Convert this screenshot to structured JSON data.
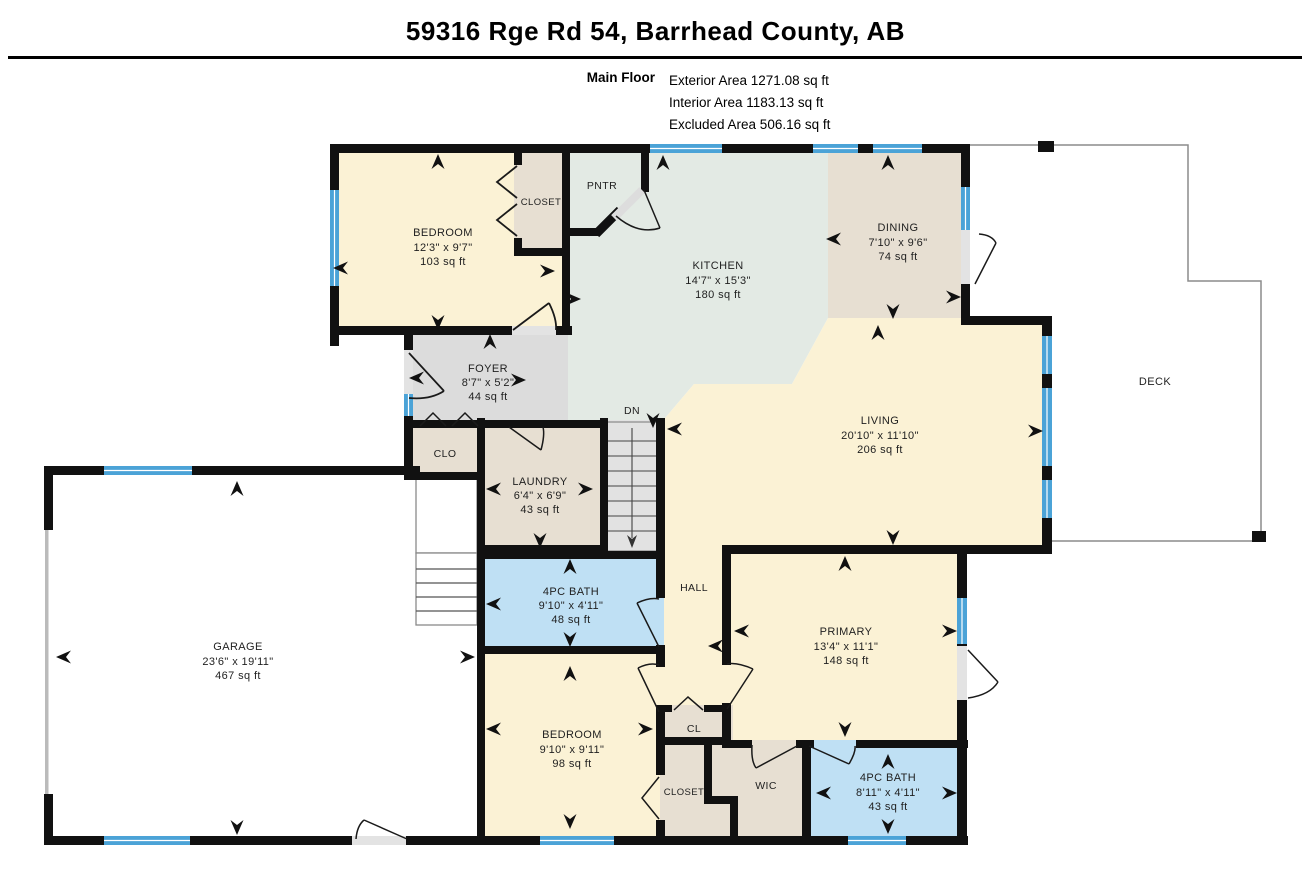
{
  "header": {
    "title": "59316 Rge Rd 54, Barrhead County, AB",
    "floor_label": "Main Floor",
    "stats": [
      "Exterior Area 1271.08 sq ft",
      "Interior Area 1183.13 sq ft",
      "Excluded Area 506.16 sq ft"
    ]
  },
  "rooms": {
    "bedroom_tl": {
      "name": "BEDROOM",
      "dims": "12'3\" x 9'7\"",
      "area": "103 sq ft"
    },
    "closet_tl": {
      "name": "CLOSET"
    },
    "pantry": {
      "name": "PNTR"
    },
    "kitchen": {
      "name": "KITCHEN",
      "dims": "14'7\" x 15'3\"",
      "area": "180 sq ft"
    },
    "dining": {
      "name": "DINING",
      "dims": "7'10\" x 9'6\"",
      "area": "74 sq ft"
    },
    "foyer": {
      "name": "FOYER",
      "dims": "8'7\" x 5'2\"",
      "area": "44 sq ft"
    },
    "living": {
      "name": "LIVING",
      "dims": "20'10\" x 11'10\"",
      "area": "206 sq ft"
    },
    "deck": {
      "name": "DECK"
    },
    "clo": {
      "name": "CLO"
    },
    "laundry": {
      "name": "LAUNDRY",
      "dims": "6'4\" x 6'9\"",
      "area": "43 sq ft"
    },
    "stairs": {
      "name": "DN"
    },
    "garage": {
      "name": "GARAGE",
      "dims": "23'6\" x 19'11\"",
      "area": "467 sq ft"
    },
    "bath_main": {
      "name": "4PC BATH",
      "dims": "9'10\" x 4'11\"",
      "area": "48 sq ft"
    },
    "hall": {
      "name": "HALL"
    },
    "primary": {
      "name": "PRIMARY",
      "dims": "13'4\" x 11'1\"",
      "area": "148 sq ft"
    },
    "bedroom_b": {
      "name": "BEDROOM",
      "dims": "9'10\" x 9'11\"",
      "area": "98 sq ft"
    },
    "cl": {
      "name": "CL"
    },
    "closet_b": {
      "name": "CLOSET"
    },
    "wic": {
      "name": "WIC"
    },
    "bath_ensuite": {
      "name": "4PC BATH",
      "dims": "8'11\" x 4'11\"",
      "area": "43 sq ft"
    }
  },
  "colors": {
    "room_cream": "#FBF2D5",
    "room_beige": "#E7DFD2",
    "room_green": "#E3EAE4",
    "room_gray": "#DCDCDC",
    "room_blue": "#BFE0F4",
    "room_white": "#FFFFFF",
    "stairs_gray": "#E2E2E2",
    "wall": "#111111",
    "window": "#4BA3D7",
    "deck_outline": "#8C8C8C"
  }
}
